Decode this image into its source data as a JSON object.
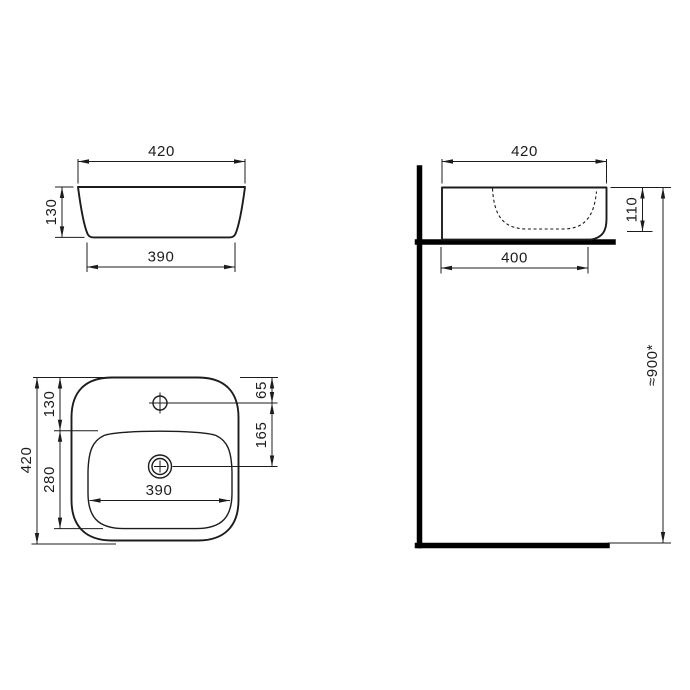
{
  "drawing": {
    "type": "sanitaryware-dimension-drawing",
    "subject": "countertop-washbasin",
    "units_implied": "mm",
    "colors": {
      "background": "#ffffff",
      "line": "#1c1c1c",
      "section_heavy_line": "#000000"
    },
    "views": {
      "front_view": {
        "dims": {
          "overall_width": "420",
          "height": "130",
          "base_width": "390"
        }
      },
      "side_view": {
        "dims": {
          "overall_depth": "420",
          "rim_height": "110",
          "base_depth": "400",
          "mounting_height": "≈900*"
        }
      },
      "plan_view": {
        "dims": {
          "overall_depth": "420",
          "rim_to_bowl": "130",
          "bowl_depth": "280",
          "faucet_hole_offset": "65",
          "faucet_to_drain": "165",
          "bowl_width": "390"
        }
      }
    }
  }
}
